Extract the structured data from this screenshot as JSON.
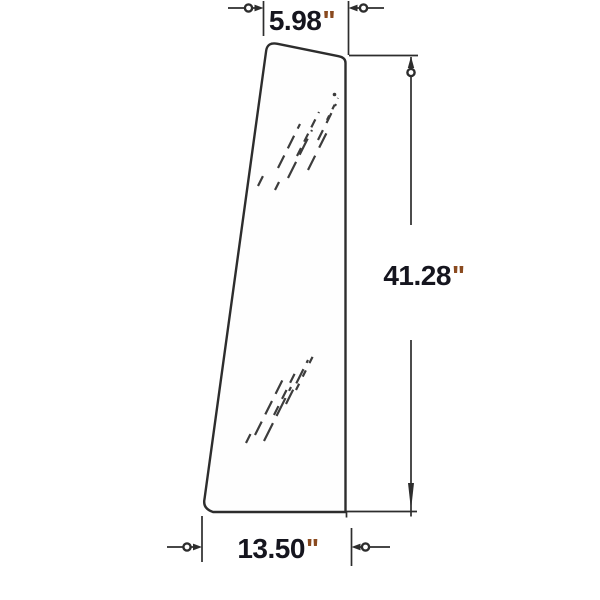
{
  "drawing": {
    "subject": "Tapered glass panel technical diagram",
    "dimensions": {
      "top_width": {
        "label": "5.98\"",
        "value": "5.98",
        "unit": "\""
      },
      "height": {
        "label": "41.28\"",
        "value": "41.28",
        "unit": "\""
      },
      "bottom_width": {
        "label": "13.50\"",
        "value": "13.50",
        "unit": "\""
      }
    },
    "style": {
      "line_color": "#2d2d2d",
      "hatch_color": "#3c3c3c",
      "text_color": "#15151e",
      "inch_mark_color": "#8a4a1f",
      "background": "#ffffff"
    }
  }
}
